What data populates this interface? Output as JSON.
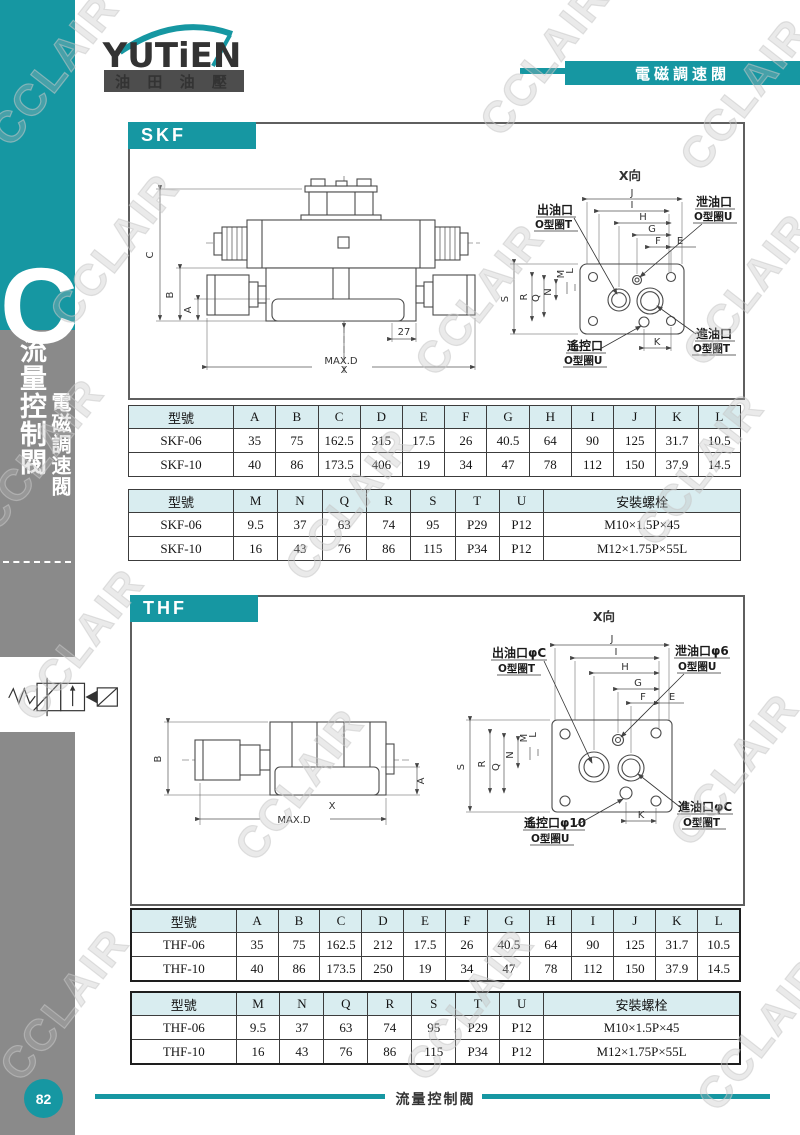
{
  "colors": {
    "accent": "#1697a2",
    "sidebar_gray": "#8a8a8a",
    "table_header_bg": "#d9edf0",
    "logo_bar": "#4d4d4d"
  },
  "watermark": {
    "text": "CCLAIR"
  },
  "brand": {
    "logo_text": "YUTiEN",
    "logo_sub": "油 田 油 壓",
    "banner": "電磁調速閥"
  },
  "sidebar": {
    "letter": "C",
    "title1": "流量控制閥",
    "title2": "電磁調速閥"
  },
  "page": {
    "number": "82",
    "footer": "流量控制閥"
  },
  "skf": {
    "title": "SKF",
    "front": {
      "c": "C",
      "b": "B",
      "a": "A",
      "x": "X",
      "maxd": "MAX.D",
      "d27": "27"
    },
    "top": {
      "title": "X向",
      "dims": {
        "j": "J",
        "i": "I",
        "h": "H",
        "g": "G",
        "f": "F",
        "e": "E",
        "s": "S",
        "r": "R",
        "q": "Q",
        "n": "N",
        "m": "M",
        "l": "L",
        "k": "K"
      },
      "ports": {
        "out1": "出油口",
        "out2": "O型圈T",
        "drain1": "泄油口",
        "drain2": "O型圈U",
        "remote1": "遙控口",
        "remote2": "O型圈U",
        "in1": "進油口",
        "in2": "O型圈T"
      }
    },
    "table1": {
      "headers": [
        "型號",
        "A",
        "B",
        "C",
        "D",
        "E",
        "F",
        "G",
        "H",
        "I",
        "J",
        "K",
        "L"
      ],
      "rows": [
        [
          "SKF-06",
          "35",
          "75",
          "162.5",
          "315",
          "17.5",
          "26",
          "40.5",
          "64",
          "90",
          "125",
          "31.7",
          "10.5"
        ],
        [
          "SKF-10",
          "40",
          "86",
          "173.5",
          "406",
          "19",
          "34",
          "47",
          "78",
          "112",
          "150",
          "37.9",
          "14.5"
        ]
      ]
    },
    "table2": {
      "headers": [
        "型號",
        "M",
        "N",
        "Q",
        "R",
        "S",
        "T",
        "U",
        "安裝螺栓"
      ],
      "rows": [
        [
          "SKF-06",
          "9.5",
          "37",
          "63",
          "74",
          "95",
          "P29",
          "P12",
          "M10×1.5P×45"
        ],
        [
          "SKF-10",
          "16",
          "43",
          "76",
          "86",
          "115",
          "P34",
          "P12",
          "M12×1.75P×55L"
        ]
      ]
    }
  },
  "thf": {
    "title": "THF",
    "front": {
      "b": "B",
      "a": "A",
      "x": "X",
      "maxd": "MAX.D"
    },
    "top": {
      "title": "X向",
      "dims": {
        "j": "J",
        "i": "I",
        "h": "H",
        "g": "G",
        "f": "F",
        "e": "E",
        "s": "S",
        "r": "R",
        "q": "Q",
        "n": "N",
        "m": "M",
        "l": "L",
        "k": "K"
      },
      "ports": {
        "out1": "出油口φC",
        "out2": "O型圈T",
        "drain1": "泄油口φ6",
        "drain2": "O型圈U",
        "remote1": "遙控口φ10",
        "remote2": "O型圈U",
        "in1": "進油口φC",
        "in2": "O型圈T"
      }
    },
    "table1": {
      "headers": [
        "型號",
        "A",
        "B",
        "C",
        "D",
        "E",
        "F",
        "G",
        "H",
        "I",
        "J",
        "K",
        "L"
      ],
      "rows": [
        [
          "THF-06",
          "35",
          "75",
          "162.5",
          "212",
          "17.5",
          "26",
          "40.5",
          "64",
          "90",
          "125",
          "31.7",
          "10.5"
        ],
        [
          "THF-10",
          "40",
          "86",
          "173.5",
          "250",
          "19",
          "34",
          "47",
          "78",
          "112",
          "150",
          "37.9",
          "14.5"
        ]
      ]
    },
    "table2": {
      "headers": [
        "型號",
        "M",
        "N",
        "Q",
        "R",
        "S",
        "T",
        "U",
        "安裝螺栓"
      ],
      "rows": [
        [
          "THF-06",
          "9.5",
          "37",
          "63",
          "74",
          "95",
          "P29",
          "P12",
          "M10×1.5P×45"
        ],
        [
          "THF-10",
          "16",
          "43",
          "76",
          "86",
          "115",
          "P34",
          "P12",
          "M12×1.75P×55L"
        ]
      ]
    }
  }
}
